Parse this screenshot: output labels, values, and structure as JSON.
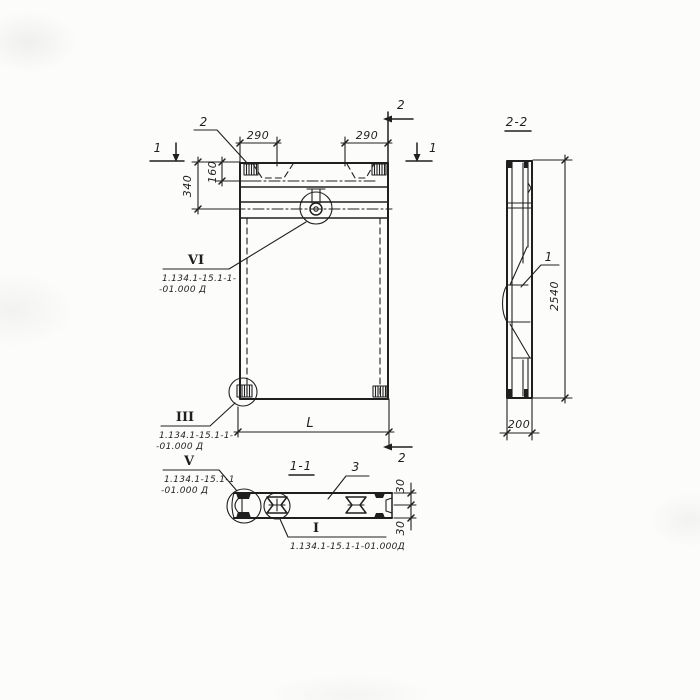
{
  "drawing": {
    "colors": {
      "ink": "#1f1f1f",
      "paper": "#fcfcfb"
    },
    "front_view": {
      "dim_290_left": "290",
      "dim_290_right": "290",
      "dim_340": "340",
      "dim_160": "160",
      "dim_length": "L",
      "cut_label_1_left": "1",
      "cut_label_1_right": "1",
      "cut_label_2_top": "2",
      "cut_label_2_bottom": "2",
      "corner_leader_label": "2"
    },
    "section_2_2": {
      "title": "2-2",
      "dim_height": "2540",
      "dim_width": "200",
      "part_label": "1"
    },
    "section_1_1": {
      "title": "1-1",
      "part_label": "3",
      "dim_30_top": "30",
      "dim_30_bottom": "30"
    },
    "details": {
      "vi": {
        "numeral": "VI",
        "ref_line1": "1.134.1-15.1-1-",
        "ref_line2": "-01.000 Д"
      },
      "iii": {
        "numeral": "III",
        "ref_line1": "1.134.1-15.1-1-",
        "ref_line2": "-01.000 Д"
      },
      "v": {
        "numeral": "V",
        "ref_line1": "1.134.1-15.1-1",
        "ref_line2": "-01.000 Д"
      },
      "i": {
        "numeral": "I",
        "ref": "1.134.1-15.1-1-01.000Д"
      }
    }
  }
}
